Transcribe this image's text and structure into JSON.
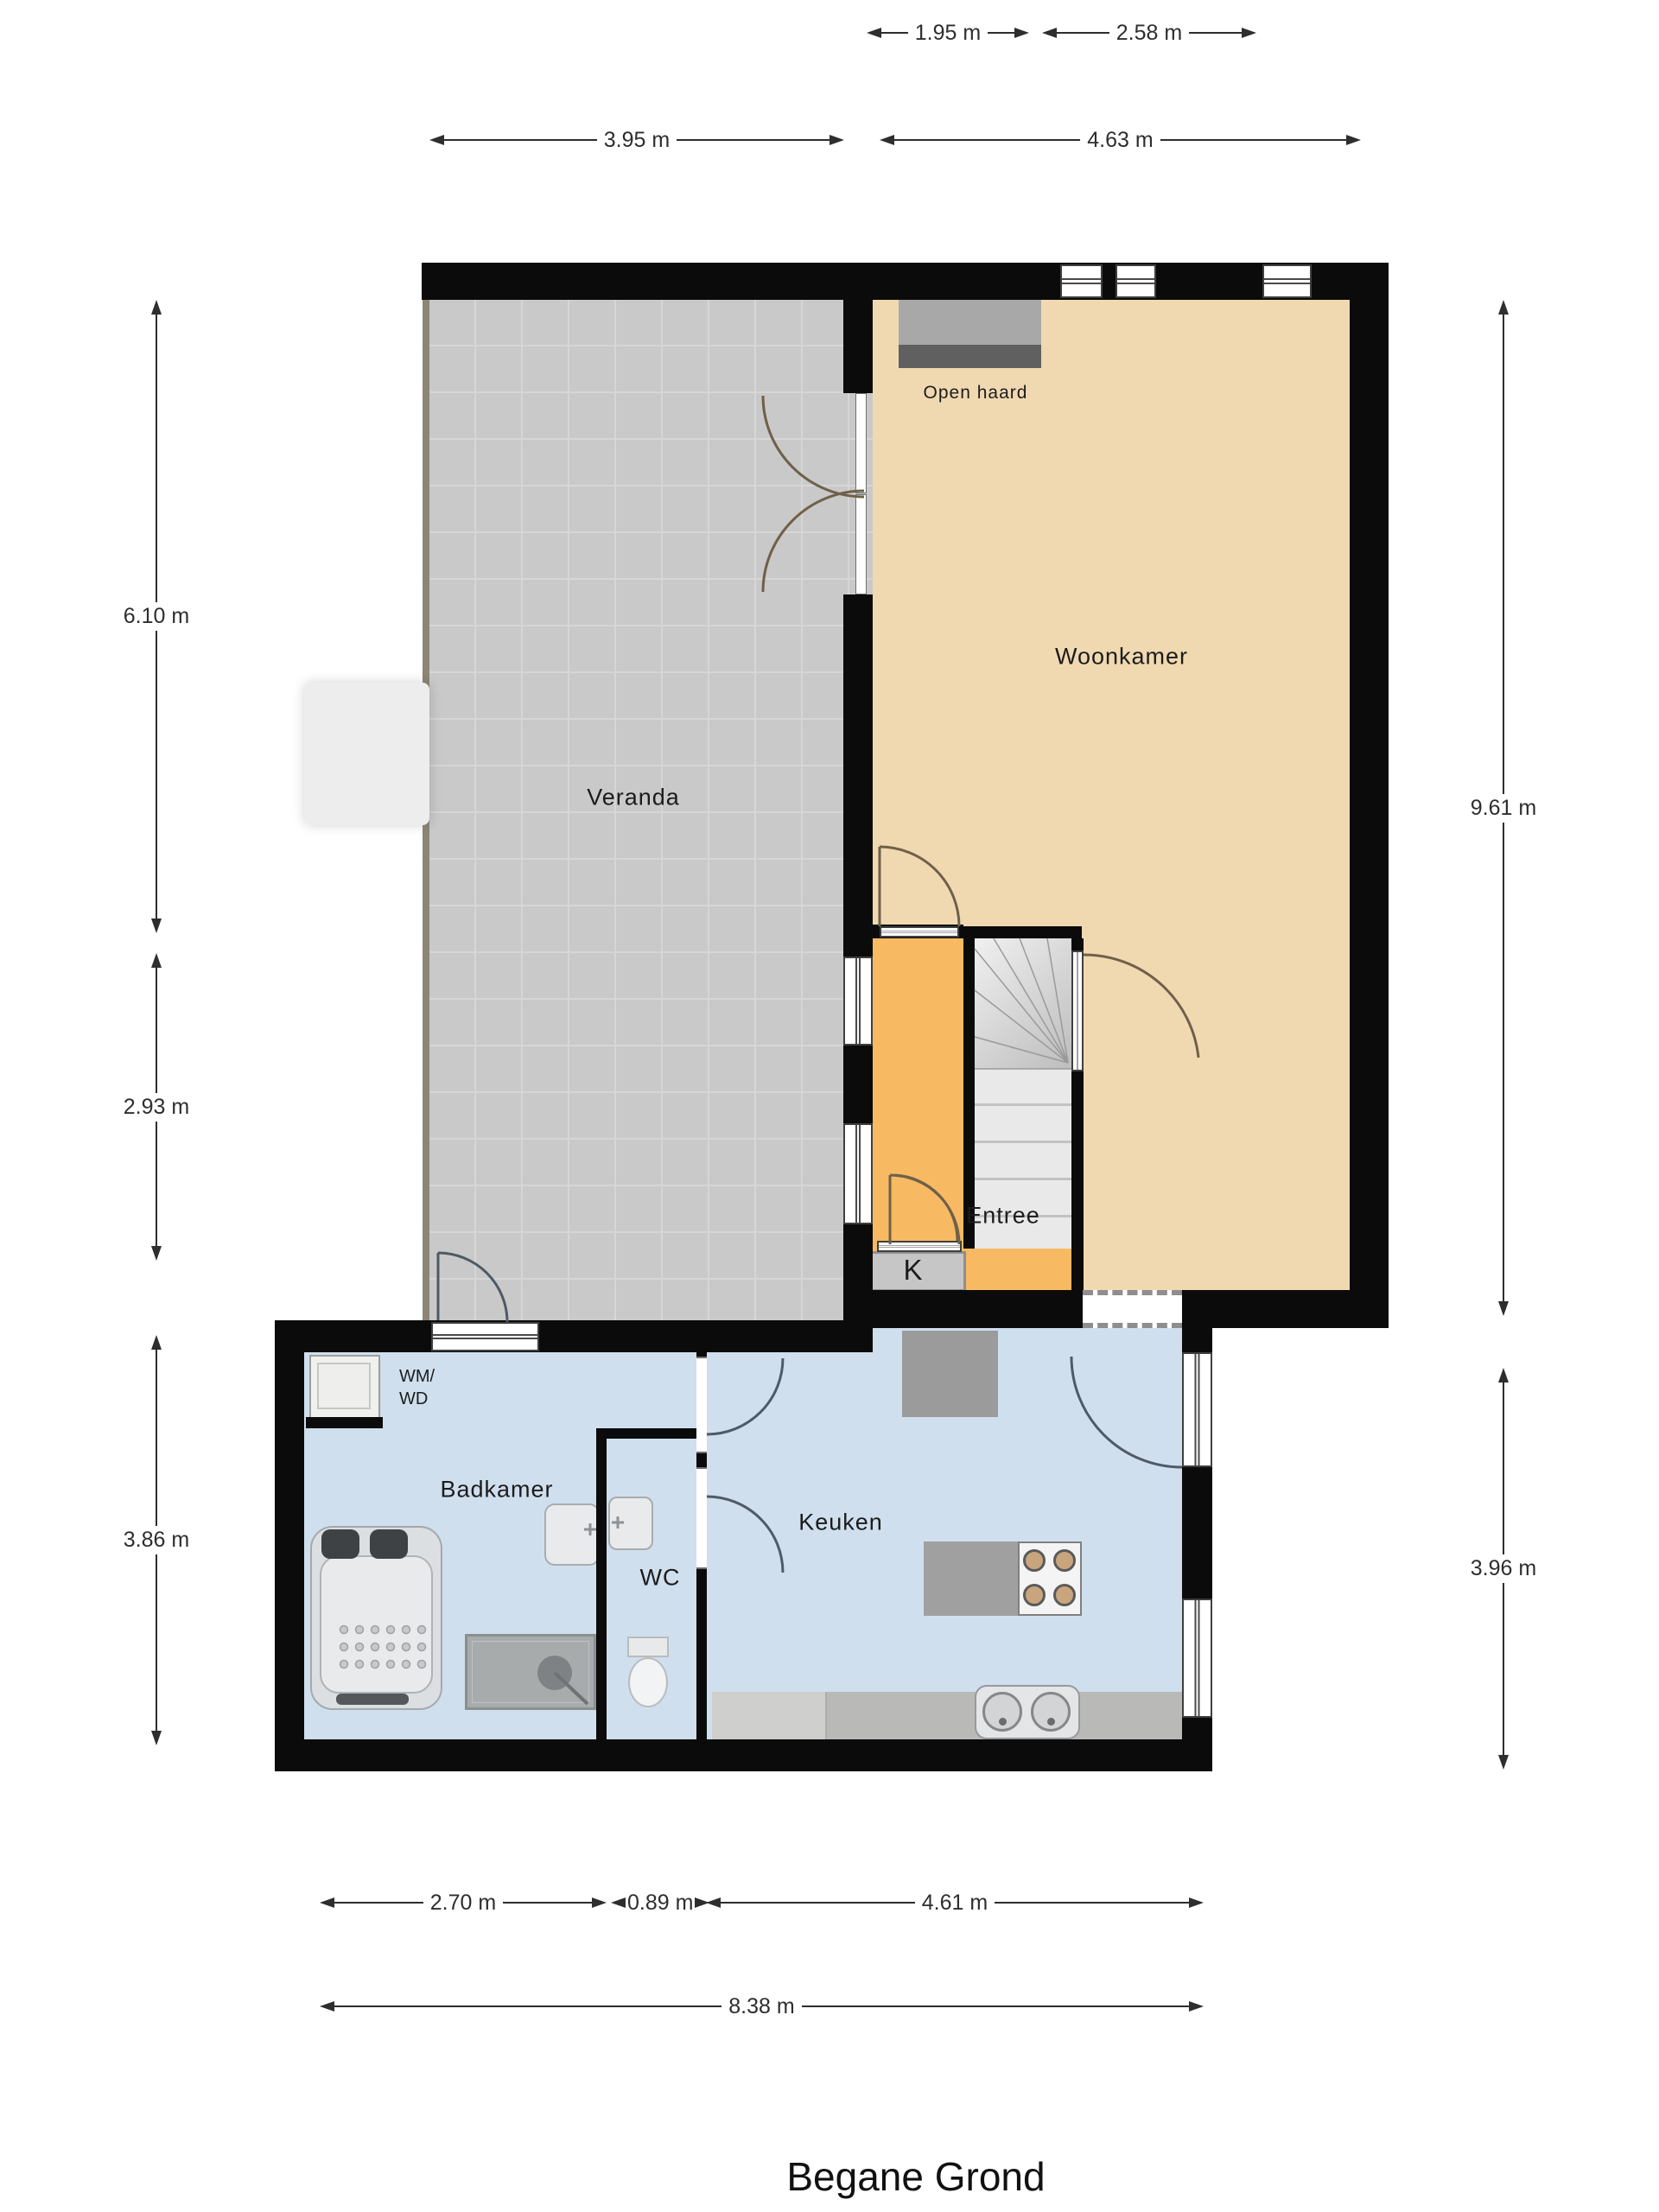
{
  "title": "Begane Grond",
  "rooms": {
    "veranda": "Veranda",
    "woonkamer": "Woonkamer",
    "entree": "Entree",
    "keuken": "Keuken",
    "badkamer": "Badkamer",
    "wc": "WC",
    "kast": "K",
    "wm_wd_line1": "WM/",
    "wm_wd_line2": "WD",
    "open_haard": "Open haard"
  },
  "dimensions": {
    "w_195": "1.95 m",
    "w_258": "2.58 m",
    "w_395": "3.95 m",
    "w_463": "4.63 m",
    "h_610": "6.10 m",
    "h_293": "2.93 m",
    "h_386": "3.86 m",
    "h_961": "9.61 m",
    "h_396": "3.96 m",
    "w_270": "2.70 m",
    "w_089": "0.89 m",
    "w_461": "4.61 m",
    "w_838": "8.38 m"
  },
  "colors": {
    "wall": "#0b0b0b",
    "text": "#1c1c1c",
    "dim": "#2e2e2e",
    "veranda": "#c9c9c9",
    "verandaline": "#8d8575",
    "tile": "#d6d6d6",
    "woonkamer": "#f0d9b1",
    "entree": "#f7ba63",
    "blue": "#cfdfee",
    "stairs": "#dcdcdc",
    "kast": "#c6c6c6",
    "fireplacetop": "#a8a8a8",
    "fireplacebottom": "#606060",
    "counter": "#b9b9b7",
    "cabinet": "#9b9b9b",
    "island": "#a0a0a0",
    "hob": "#f4f4f4",
    "burner": "#c9a57e",
    "arcwarm": "#6f6049",
    "arccool": "#4e5a66",
    "windowline": "#4a4a4a",
    "dash": "#8e8e8e",
    "fixture": "#e9eaec",
    "fixtureborder": "#a9acae"
  }
}
